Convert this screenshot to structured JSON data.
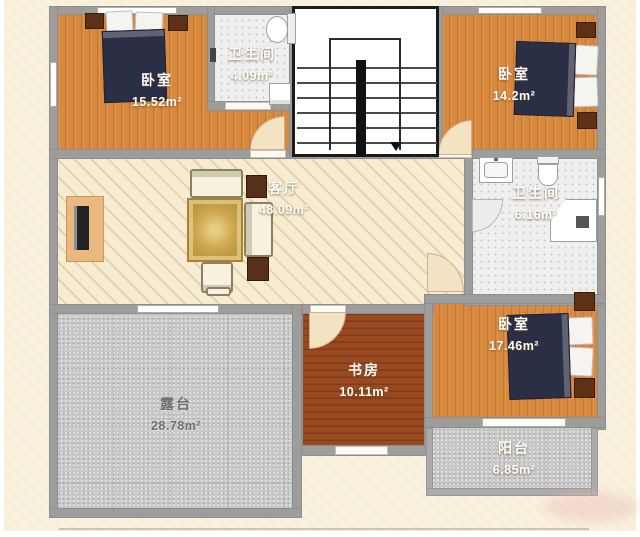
{
  "plan": {
    "title": "second-floor-plan",
    "rooms": [
      {
        "name": "卧室",
        "area": "15.52m²",
        "position": "top-left"
      },
      {
        "name": "卫生间",
        "area": "4.09m²",
        "position": "top-middle"
      },
      {
        "name": "卧室",
        "area": "14.2m²",
        "position": "top-right"
      },
      {
        "name": "客厅",
        "area": "48.09m²",
        "position": "center"
      },
      {
        "name": "卫生间",
        "area": "6.16m²",
        "position": "middle-right"
      },
      {
        "name": "卧室",
        "area": "17.46m²",
        "position": "bottom-right"
      },
      {
        "name": "书房",
        "area": "10.11m²",
        "position": "bottom-middle"
      },
      {
        "name": "露台",
        "area": "28.78m²",
        "position": "bottom-left"
      },
      {
        "name": "阳台",
        "area": "6.85m²",
        "position": "bottom-right-edge"
      }
    ],
    "stairs": {
      "direction": "down"
    },
    "fixtures": [
      "double-bed",
      "nightstand",
      "sofa-set",
      "rug",
      "tv-stand",
      "toilet",
      "sink",
      "corner-shower",
      "washer",
      "door-arc",
      "window"
    ],
    "colors": {
      "background": "#f8efd9",
      "wall": "#9d9d9d",
      "wood_floor": "#d8893e",
      "study_floor": "#9a4a20",
      "living_floor": "#f7ecd2",
      "tile_floor": "#efefef",
      "terrace_floor": "#c8c8c8",
      "bed": "#2b2f45",
      "nightstand": "#5c3115",
      "rug": "#c9a44e",
      "room_label": "#ffffff",
      "terrace_label": "#6f6f6f"
    }
  }
}
